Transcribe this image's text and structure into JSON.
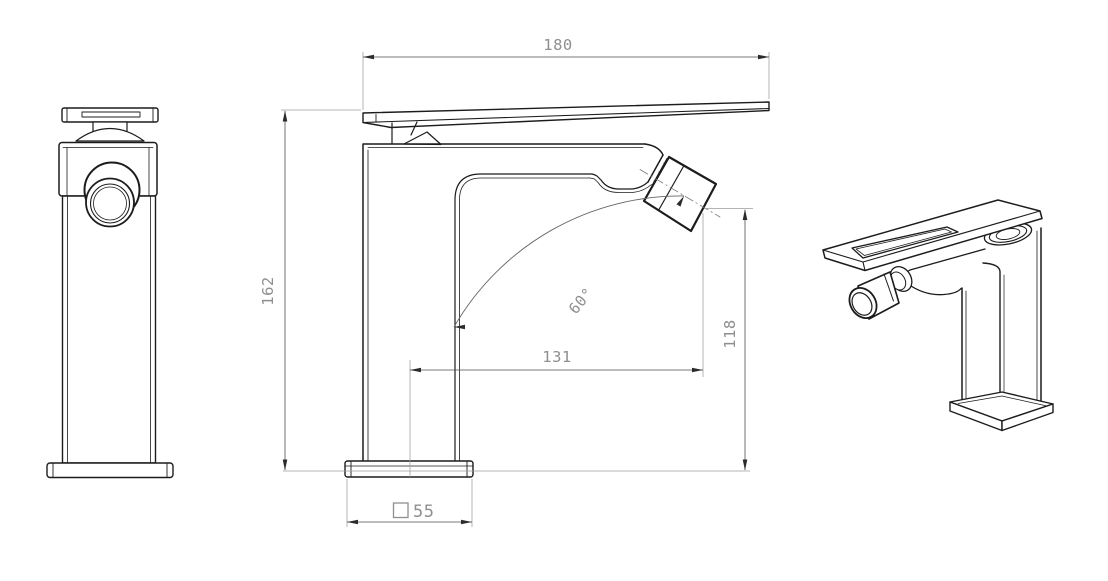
{
  "colors": {
    "background": "#ffffff",
    "outline": "#1c1c1c",
    "dimension_line": "#4d4d4d",
    "extension_line": "#9b9b9b",
    "dimension_text": "#8f8f8f",
    "arrowhead": "#2b2b2b"
  },
  "dimensions": {
    "handle_length": "180",
    "overall_height": "162",
    "spout_reach": "131",
    "spout_tip_height": "118",
    "spout_angle": "60°",
    "base_size": "55"
  }
}
